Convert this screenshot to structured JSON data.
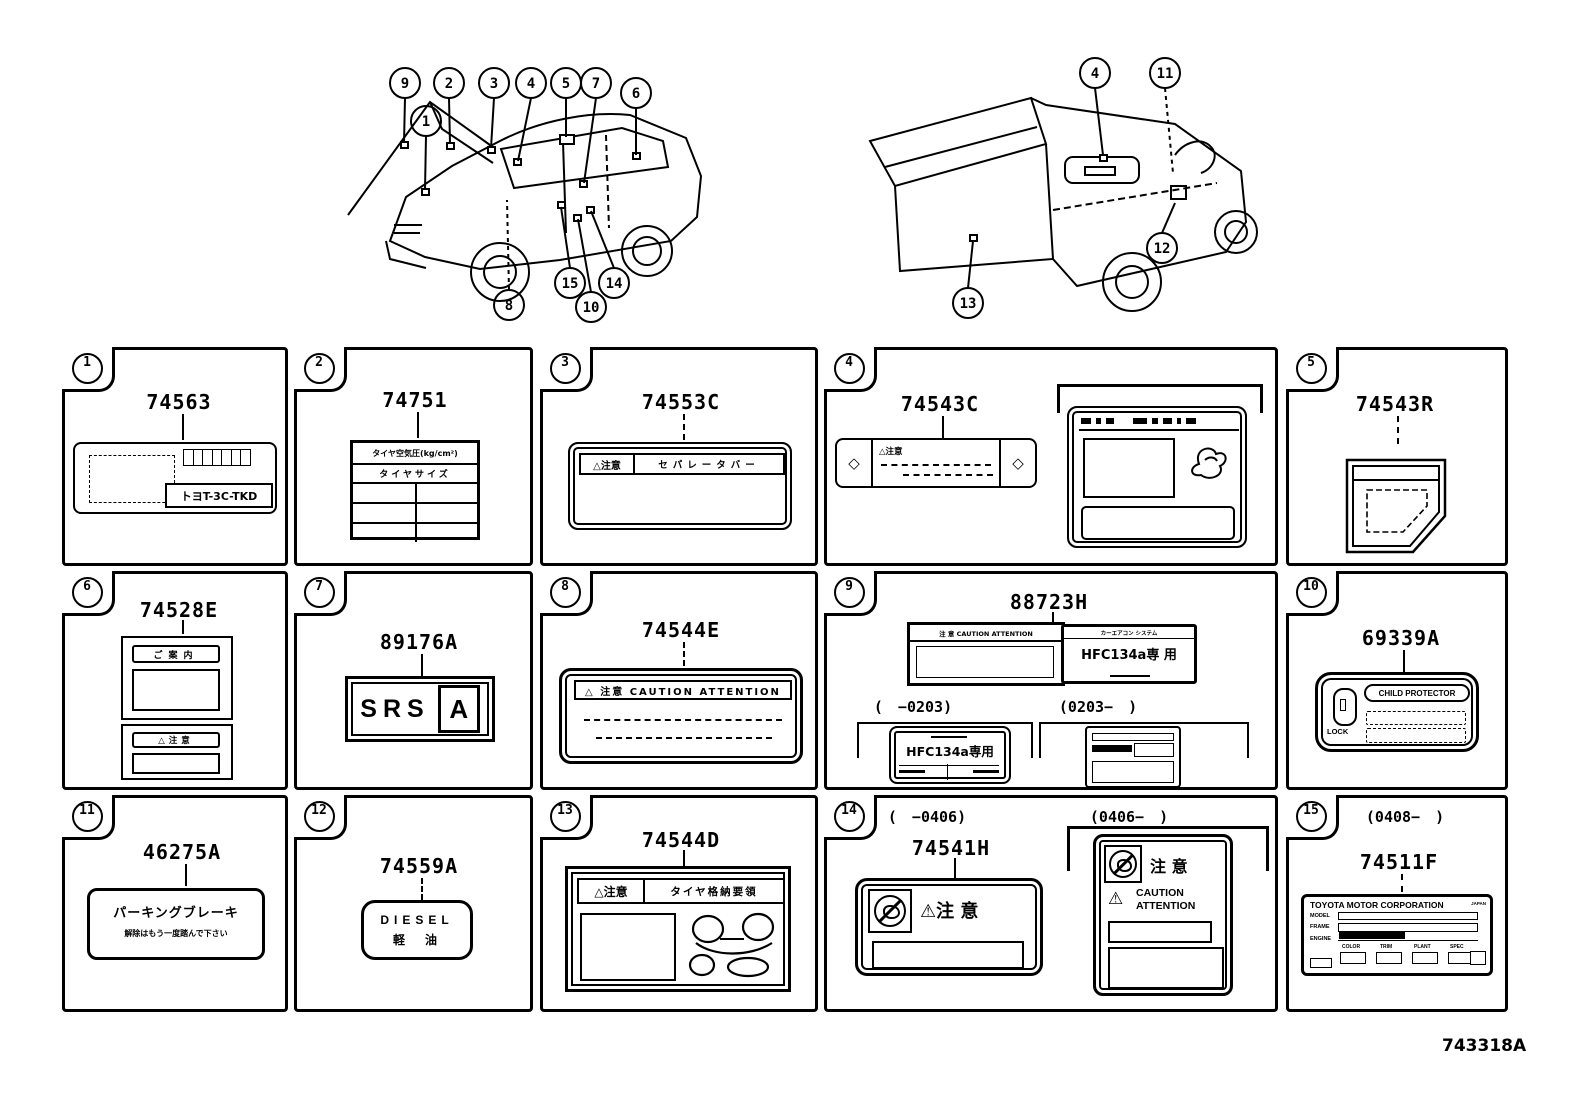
{
  "footer_code": "743318A",
  "left_diagram": {
    "callouts": {
      "n9": "9",
      "n1": "1",
      "n2": "2",
      "n3": "3",
      "n4": "4",
      "n5": "5",
      "n7": "7",
      "n6": "6",
      "n8": "8",
      "n15": "15",
      "n10": "10",
      "n14": "14"
    }
  },
  "right_diagram": {
    "callouts": {
      "n4": "4",
      "n11": "11",
      "n12": "12",
      "n13": "13"
    }
  },
  "cells": {
    "c1": {
      "num": "1",
      "part": "74563",
      "plate": "トヨT-3C-TKD"
    },
    "c2": {
      "num": "2",
      "part": "74751",
      "header": "タイヤ空気圧(kg/cm²)",
      "subheader": "タイヤサイズ"
    },
    "c3": {
      "num": "3",
      "part": "74553C",
      "caution": "△注意",
      "title": "セパレータバー"
    },
    "c4": {
      "num": "4",
      "part": "74543C",
      "caution": "△注意",
      "diamond": "◇"
    },
    "c5": {
      "num": "5",
      "part": "74543R"
    },
    "c6": {
      "num": "6",
      "part": "74528E",
      "header_top": "ご案内",
      "header_bottom": "△注意"
    },
    "c7": {
      "num": "7",
      "part": "89176A",
      "srs": "SRS",
      "a": "A"
    },
    "c8": {
      "num": "8",
      "part": "74544E",
      "header": "△ 注意 CAUTION ATTENTION"
    },
    "c9": {
      "num": "9",
      "part": "88723H",
      "caution_header": "注 意 CAUTION ATTENTION",
      "aircon_header": "カーエアコン システム",
      "hfc_large": "HFC134a専 用",
      "range_left": "(　−0203)",
      "range_right": "(0203−　)",
      "hfc_small": "HFC134a専用"
    },
    "c10": {
      "num": "10",
      "part": "69339A",
      "title": "CHILD PROTECTOR",
      "lock": "LOCK"
    },
    "c11": {
      "num": "11",
      "part": "46275A",
      "line1": "パーキングブレーキ",
      "line2": "解除はもう一度踏んで下さい"
    },
    "c12": {
      "num": "12",
      "part": "74559A",
      "line1": "DIESEL",
      "line2": "軽　油"
    },
    "c13": {
      "num": "13",
      "part": "74544D",
      "caution": "△注意",
      "title": "タイヤ格納要領"
    },
    "c14": {
      "num": "14",
      "part": "74541H",
      "range_left": "(　−0406)",
      "range_right": "(0406−　)",
      "warn": "⚠",
      "caution_jp": "注 意",
      "caution2_jp": "注 意",
      "caution_en1": "CAUTION",
      "caution_en2": "ATTENTION"
    },
    "c15": {
      "num": "15",
      "part": "74511F",
      "range": "(0408−　)",
      "corp": "TOYOTA MOTOR CORPORATION",
      "country": "JAPAN",
      "row_model": "MODEL",
      "row_frame": "FRAME",
      "row_engine": "ENGINE",
      "col1": "COLOR",
      "col2": "TRIM",
      "col3": "PLANT",
      "col4": "SPEC"
    }
  }
}
